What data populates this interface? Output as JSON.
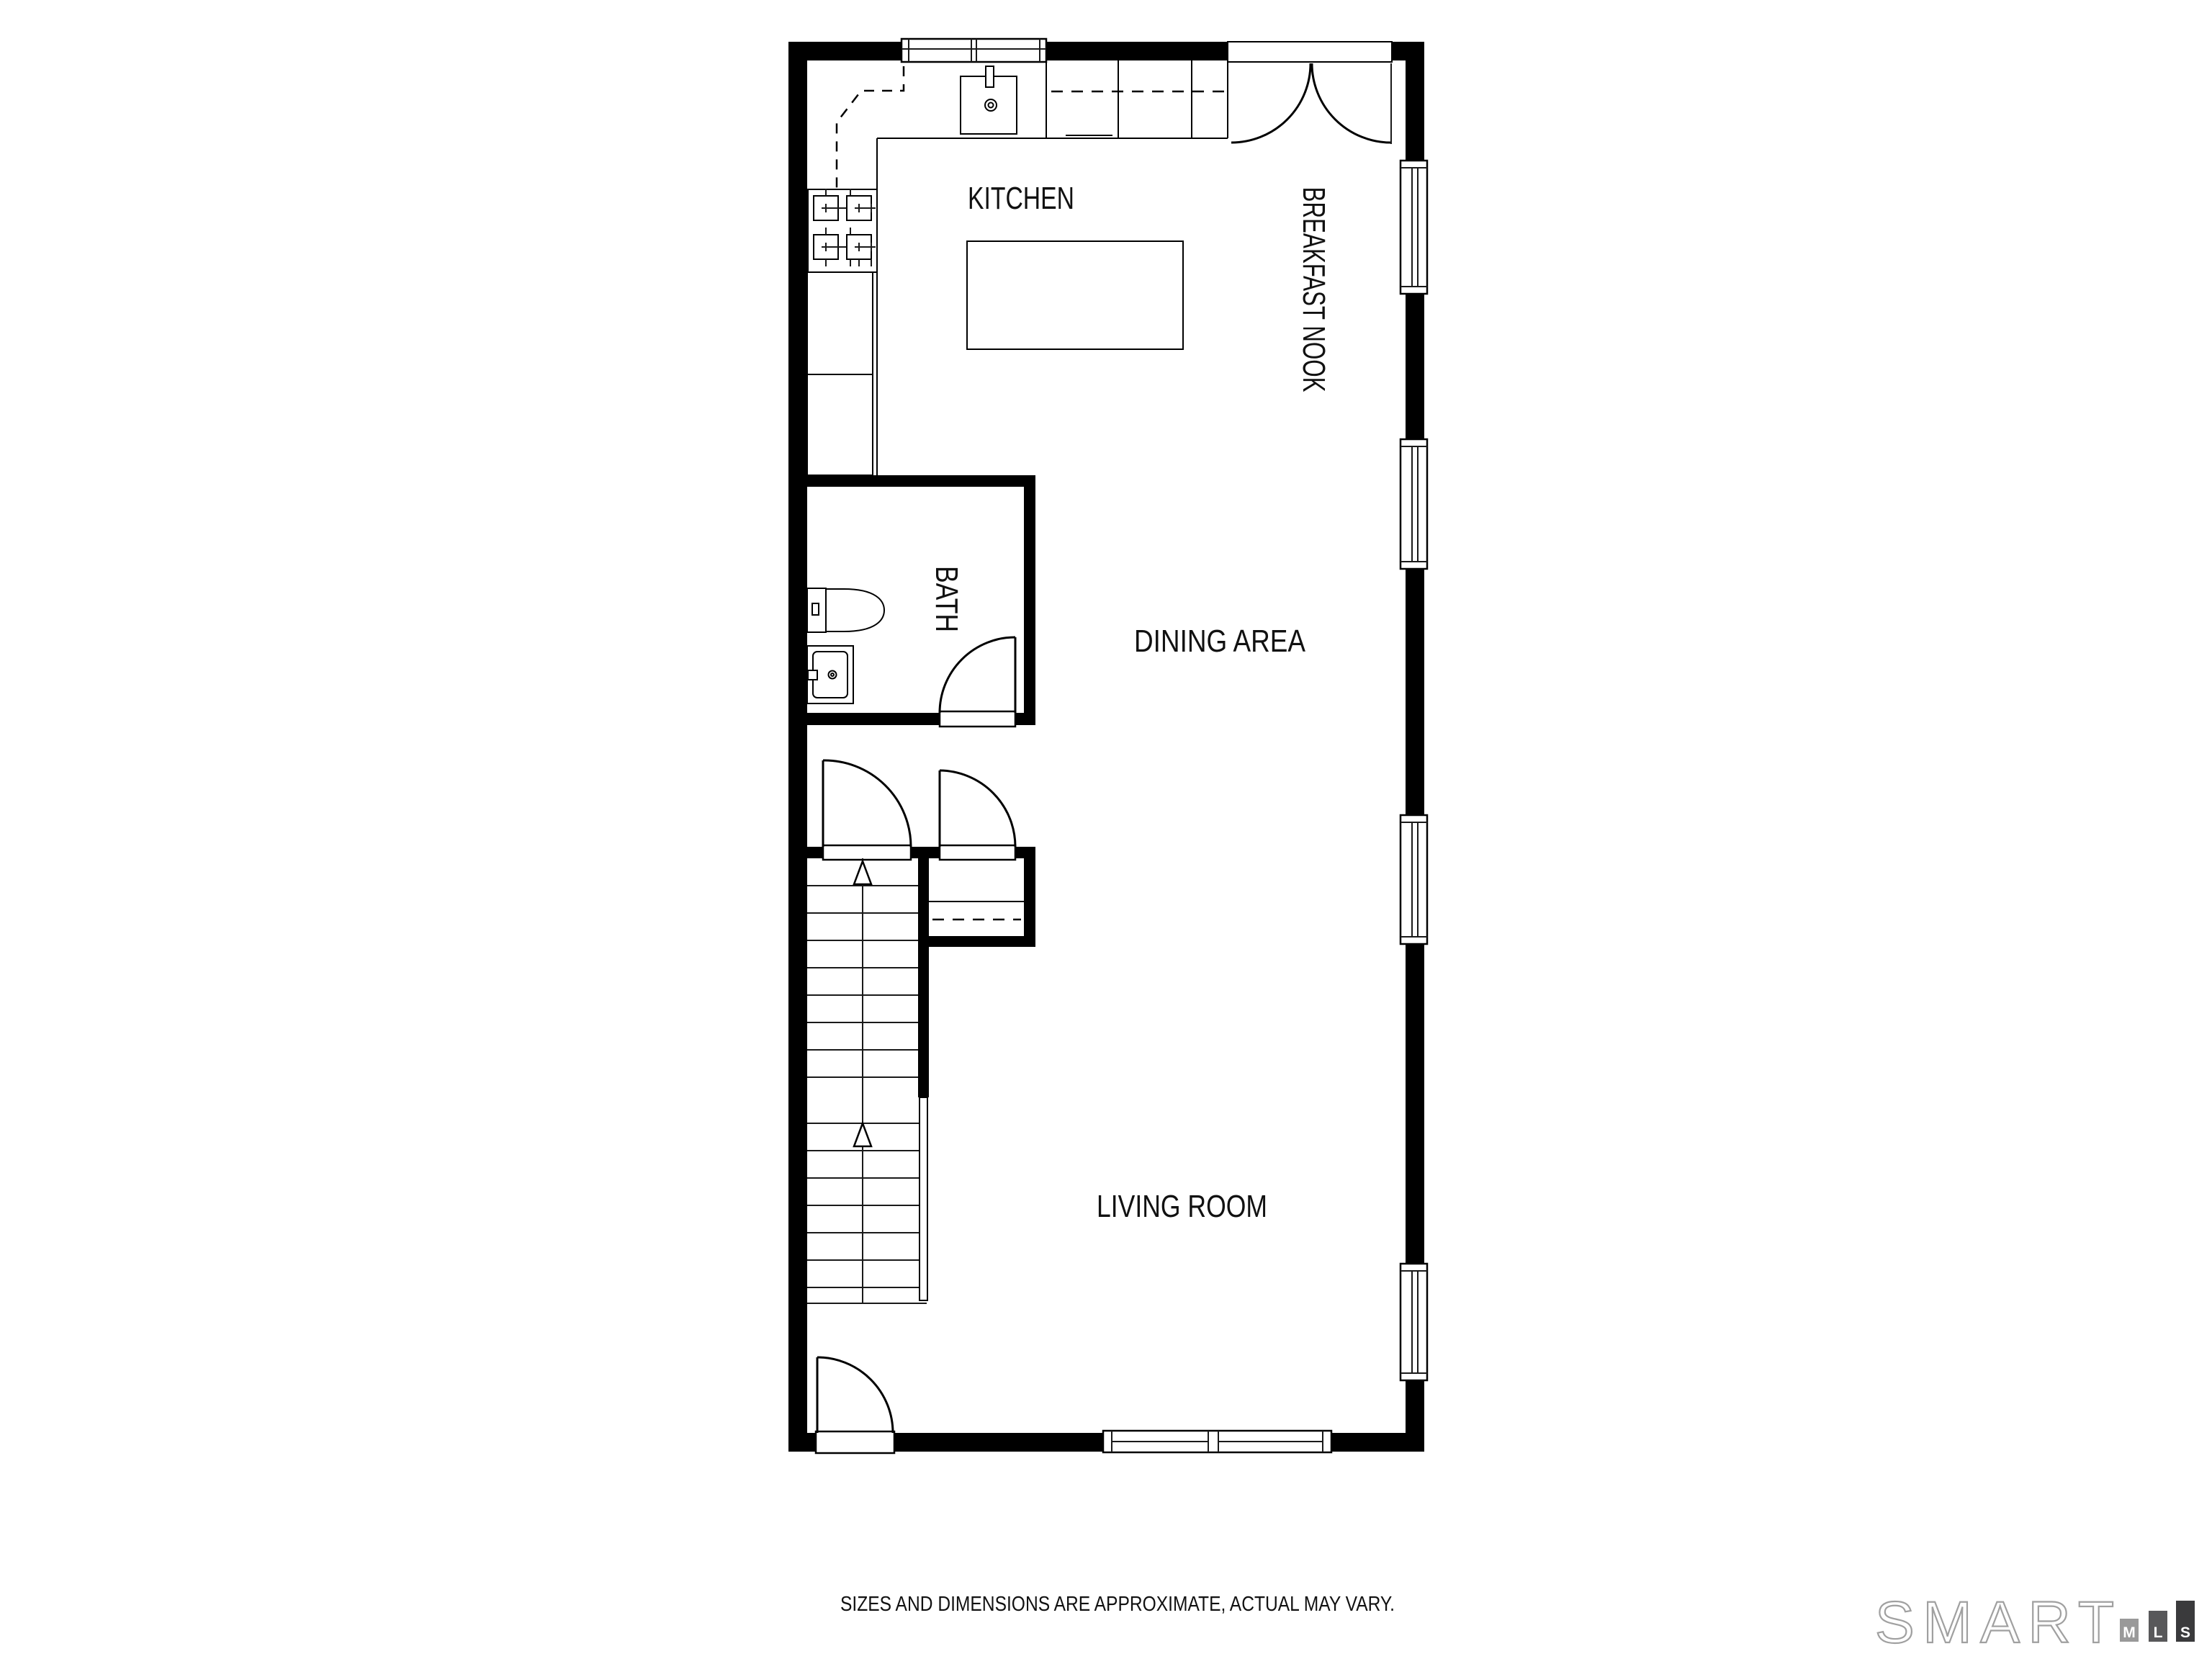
{
  "page": {
    "background": "#ffffff"
  },
  "colors": {
    "wall": "#000000",
    "line": "#000000"
  },
  "floor_plan": {
    "rooms": {
      "kitchen": {
        "label": "KITCHEN"
      },
      "breakfast_nook": {
        "label": "BREAKFAST NOOK"
      },
      "bath": {
        "label": "BATH"
      },
      "dining_area": {
        "label": "DINING AREA"
      },
      "living_room": {
        "label": "LIVING ROOM"
      }
    },
    "features": [
      "range-burners",
      "kitchen-sink",
      "kitchen-island",
      "toilet",
      "bath-vanity",
      "stairs-up",
      "closet",
      "entry-door",
      "double-curtain-door",
      "windows"
    ]
  },
  "footer": {
    "disclaimer": "SIZES AND DIMENSIONS ARE APPROXIMATE, ACTUAL MAY VARY."
  },
  "logo": {
    "brand": "SMART",
    "brand_outline_color": "#a0a0a0",
    "bars": [
      {
        "letter": "M",
        "box_color": "#999999"
      },
      {
        "letter": "L",
        "box_color": "#58585a"
      },
      {
        "letter": "S",
        "box_color": "#3a3a3c"
      }
    ]
  }
}
